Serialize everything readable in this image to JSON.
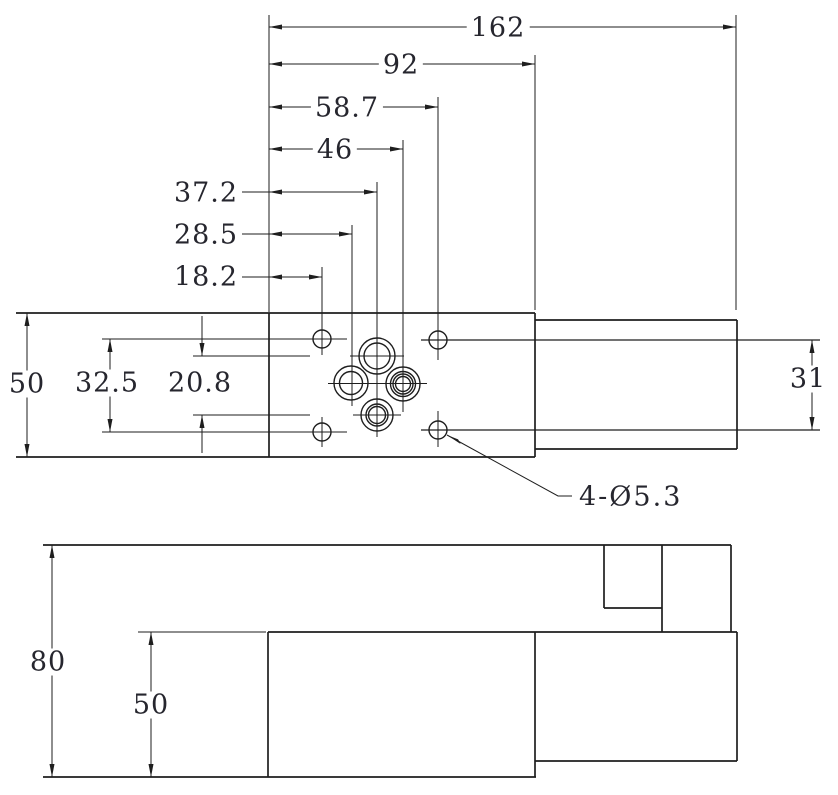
{
  "drawing": {
    "type": "engineering-dimension-drawing",
    "colors": {
      "background": "#ffffff",
      "line": "#1e1e1e",
      "text": "#26262e"
    },
    "labels": {
      "len_162": "162",
      "len_92": "92",
      "len_58_7": "58.7",
      "len_46": "46",
      "len_37_2": "37.2",
      "len_28_5": "28.5",
      "len_18_2": "18.2",
      "width_50": "50",
      "len_32_5": "32.5",
      "len_20_8": "20.8",
      "dia_31": "31",
      "height_80": "80",
      "height_50": "50",
      "hole_callout": "4-Ø5.3"
    }
  }
}
